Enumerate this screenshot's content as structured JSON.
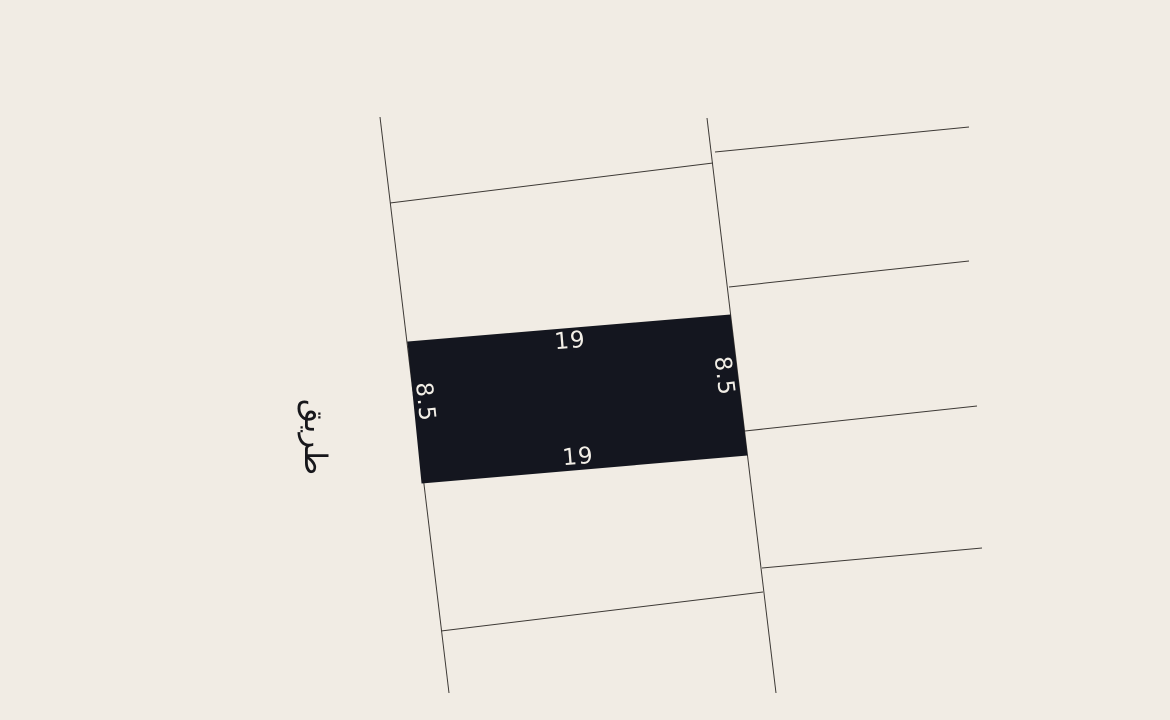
{
  "scene": {
    "type": "cadastral-plot-plan",
    "background_color": "#f1ece4",
    "line_color": "#3d3935",
    "plot_fill_color": "#14161f",
    "dimension_text_color": "#f2eee6",
    "road_text_color": "#17171b"
  },
  "highlighted_plot": {
    "corners": [
      [
        408,
        342
      ],
      [
        730,
        315
      ],
      [
        747,
        455
      ],
      [
        422,
        483
      ]
    ],
    "dimensions": {
      "top": "19",
      "bottom": "19",
      "left": "8.5",
      "right": "8.5"
    }
  },
  "road": {
    "label": "طريق"
  },
  "boundary_lines": [
    {
      "x1": 380,
      "y1": 117,
      "x2": 449,
      "y2": 693
    },
    {
      "x1": 707,
      "y1": 118,
      "x2": 776,
      "y2": 693
    },
    {
      "x1": 390,
      "y1": 203,
      "x2": 713,
      "y2": 163
    },
    {
      "x1": 441,
      "y1": 631,
      "x2": 763,
      "y2": 592
    },
    {
      "x1": 715,
      "y1": 152,
      "x2": 969,
      "y2": 127
    },
    {
      "x1": 729,
      "y1": 287,
      "x2": 969,
      "y2": 261
    },
    {
      "x1": 745,
      "y1": 431,
      "x2": 977,
      "y2": 406
    },
    {
      "x1": 762,
      "y1": 568,
      "x2": 982,
      "y2": 548
    }
  ]
}
